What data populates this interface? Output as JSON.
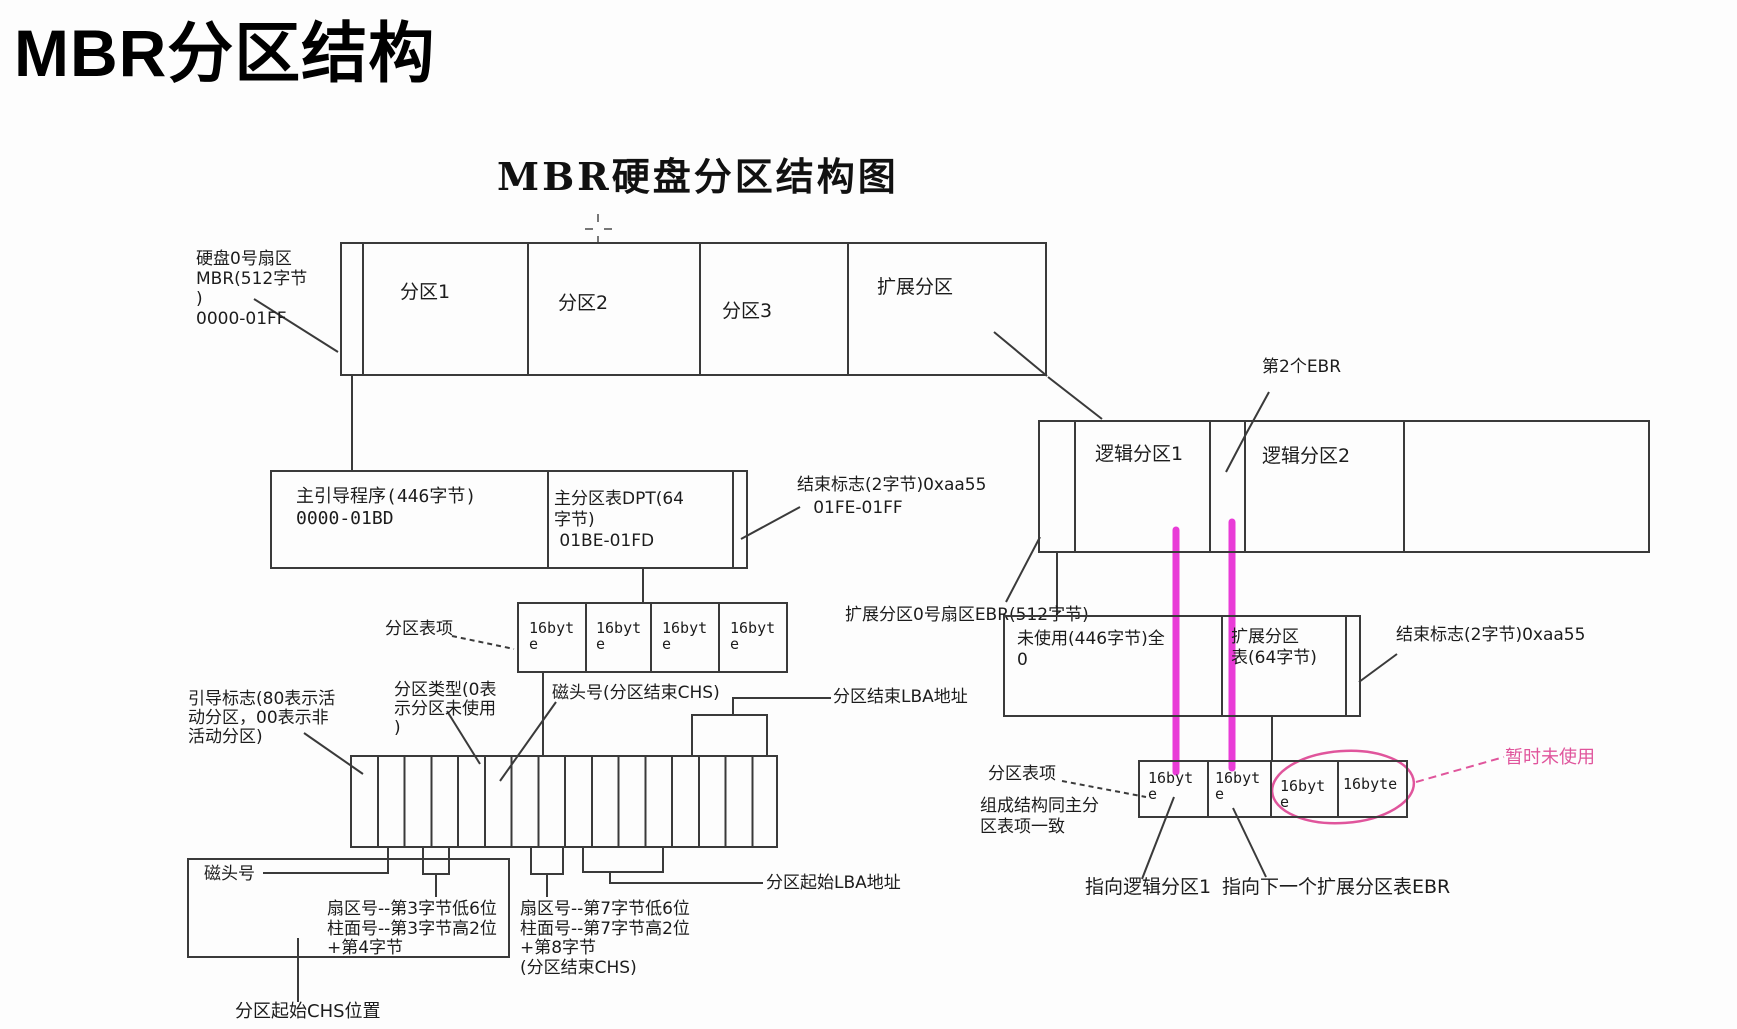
{
  "page_title": "MBR分区结构",
  "colors": {
    "line": "#3a3a3a",
    "magenta": "#E93CD7",
    "pink": "#E0559C",
    "text": "#1c1c1c"
  },
  "diagram": {
    "title": "MBR硬盘分区结构图",
    "disk_row": {
      "label": "硬盘0号扇区\nMBR(512字节\n)\n0000-01FF",
      "cells": [
        "",
        "分区1",
        "分区2",
        "分区3",
        "扩展分区"
      ]
    },
    "mbr_box": {
      "boot_code": "主引导程序(446字节)\n0000-01BD",
      "dpt": "主分区表DPT(64\n字节)\n 01BE-01FD",
      "end_flag": "结束标志(2字节)0xaa55\n   01FE-01FF"
    },
    "dpt_row": {
      "label": "分区表项",
      "cells": [
        "16byt\ne",
        "16byt\ne",
        "16byt\ne",
        "16byt\ne"
      ]
    },
    "entry_labels": {
      "boot_flag": "引导标志(80表示活\n动分区，00表示非\n活动分区)",
      "part_type": "分区类型(0表\n示分区未使用\n)",
      "head_end": "磁头号(分区结束CHS)",
      "lba_end": "分区结束LBA地址",
      "head": "磁头号",
      "sector3": "扇区号--第3字节低6位\n柱面号--第3字节高2位\n+第4字节",
      "sector7": "扇区号--第7字节低6位\n柱面号--第7字节高2位\n+第8字节\n(分区结束CHS)",
      "lba_start": "分区起始LBA地址",
      "chs_start": "分区起始CHS位置"
    },
    "ext_row": {
      "ebr2_label": "第2个EBR",
      "logical1": "逻辑分区1",
      "logical2": "逻辑分区2",
      "ebr_label": "扩展分区0号扇区EBR(512字节)"
    },
    "ebr_box": {
      "unused": "未使用(446字节)全\n0",
      "ext_table": "扩展分区\n表(64字节)",
      "end_flag": "结束标志(2字节)0xaa55"
    },
    "ebr_entry_row": {
      "label1": "分区表项",
      "label2": "组成结构同主分\n区表项一致",
      "cells": [
        "16byt\ne",
        "16byt\ne",
        "16byt\ne",
        "16byte"
      ],
      "unused_label": "暂时未使用",
      "to_logical1": "指向逻辑分区1",
      "to_next_ebr": "指向下一个扩展分区表EBR"
    }
  }
}
